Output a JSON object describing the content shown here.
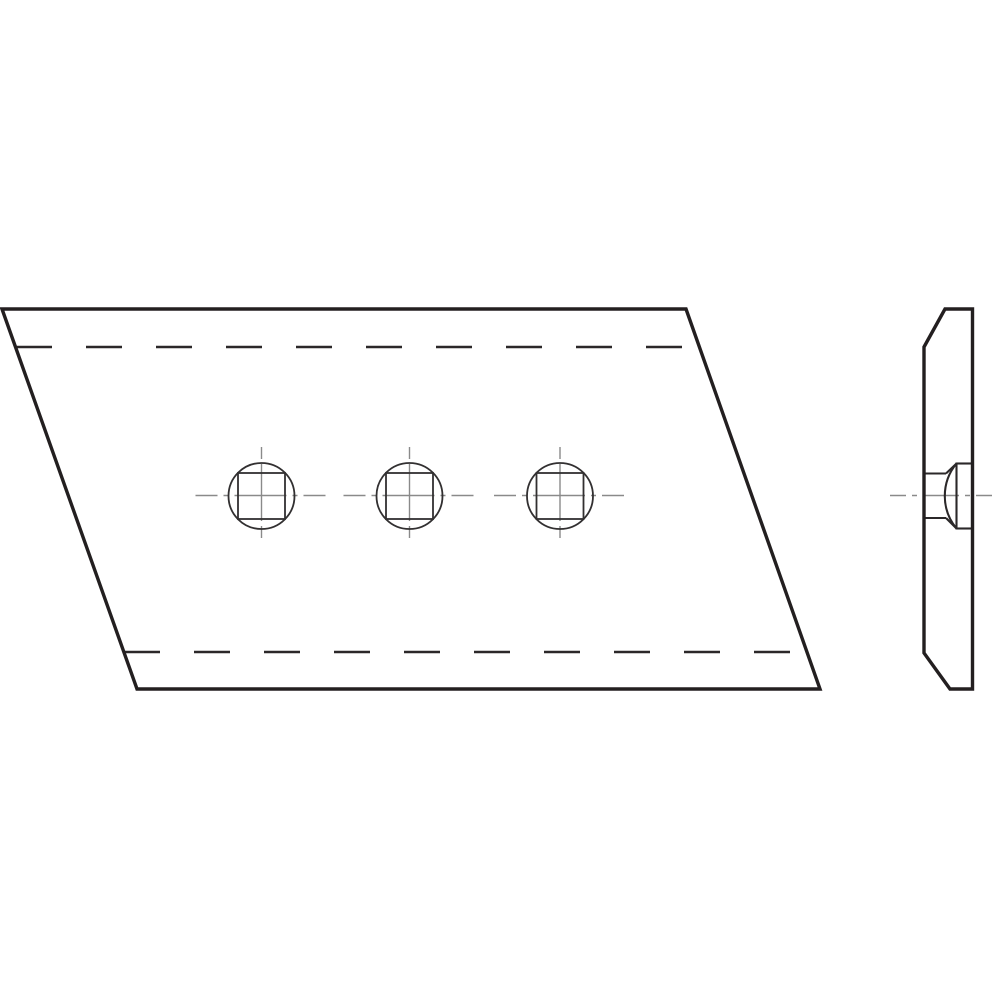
{
  "page": {
    "background": "#ffffff",
    "width": 1000,
    "height": 1000
  },
  "drawing": {
    "description": "Orthographic technical drawing: parallelogram blade plate with three countersunk square bolt holes (front view) and edge profile with flush plow-bolt head (side view)",
    "colors": {
      "ink": "#231f20",
      "feature": "#323031",
      "centerline": "#8a8a8a",
      "background": "#ffffff"
    },
    "line_styles": {
      "outline": {
        "stroke": "#231f20",
        "width": 3.4,
        "dash": ""
      },
      "hidden": {
        "stroke": "#2b2829",
        "width": 2.4,
        "dash": "36 34"
      },
      "feature": {
        "stroke": "#323031",
        "width": 1.8,
        "dash": ""
      },
      "bolt": {
        "stroke": "#2b2829",
        "width": 2.1,
        "dash": ""
      },
      "center_h": {
        "stroke": "#8a8a8a",
        "width": 1.4,
        "dash": "22 6 5 6 52 6 5 6"
      },
      "center_v": {
        "stroke": "#8a8a8a",
        "width": 1.4,
        "dash": "12 5 57 5"
      },
      "center_s": {
        "stroke": "#8a8a8a",
        "width": 1.4,
        "dash": "16 6 5 6 36 6 5 6"
      }
    },
    "front_view": {
      "elements": [
        {
          "type": "line",
          "name": "hole-1-centerline-horizontal",
          "style": "center_h",
          "x1": 195.5,
          "y1": 495.5,
          "x2": 327.5,
          "y2": 495.5
        },
        {
          "type": "line",
          "name": "hole-1-centerline-vertical",
          "style": "center_v",
          "x1": 261.5,
          "y1": 447,
          "x2": 261.5,
          "y2": 538
        },
        {
          "type": "line",
          "name": "hole-2-centerline-horizontal",
          "style": "center_h",
          "x1": 343.5,
          "y1": 495.5,
          "x2": 475.5,
          "y2": 495.5
        },
        {
          "type": "line",
          "name": "hole-2-centerline-vertical",
          "style": "center_v",
          "x1": 409.5,
          "y1": 447,
          "x2": 409.5,
          "y2": 538
        },
        {
          "type": "line",
          "name": "hole-3-centerline-horizontal",
          "style": "center_h",
          "x1": 494,
          "y1": 495.5,
          "x2": 626,
          "y2": 495.5
        },
        {
          "type": "line",
          "name": "hole-3-centerline-vertical",
          "style": "center_v",
          "x1": 560,
          "y1": 447,
          "x2": 560,
          "y2": 538
        },
        {
          "type": "line",
          "name": "hidden-bend-line-top",
          "style": "hidden",
          "x1": 16,
          "y1": 347,
          "x2": 700,
          "y2": 347
        },
        {
          "type": "line",
          "name": "hidden-bend-line-bottom",
          "style": "hidden",
          "x1": 124,
          "y1": 652,
          "x2": 809,
          "y2": 652
        },
        {
          "type": "circle",
          "name": "hole-1-circle",
          "style": "feature",
          "cx": 261.5,
          "cy": 496,
          "r": 33
        },
        {
          "type": "rect",
          "name": "hole-1-square",
          "style": "feature",
          "x": 238,
          "y": 473,
          "w": 47,
          "h": 46
        },
        {
          "type": "circle",
          "name": "hole-2-circle",
          "style": "feature",
          "cx": 409.5,
          "cy": 496,
          "r": 33
        },
        {
          "type": "rect",
          "name": "hole-2-square",
          "style": "feature",
          "x": 386,
          "y": 473,
          "w": 47,
          "h": 46
        },
        {
          "type": "circle",
          "name": "hole-3-circle",
          "style": "feature",
          "cx": 560,
          "cy": 496,
          "r": 33
        },
        {
          "type": "rect",
          "name": "hole-3-square",
          "style": "feature",
          "x": 536.5,
          "y": 473,
          "w": 47,
          "h": 46
        },
        {
          "type": "polygon",
          "name": "front-view-outline",
          "style": "outline",
          "points": "2,309 686,309 820,689 137,689"
        }
      ]
    },
    "side_view": {
      "elements": [
        {
          "type": "line",
          "name": "side-view-centerline",
          "style": "center_s",
          "x1": 890,
          "y1": 495.5,
          "x2": 995,
          "y2": 495.5
        },
        {
          "type": "line",
          "name": "bolt-hole-top-line",
          "style": "bolt",
          "x1": 922.5,
          "y1": 473.5,
          "x2": 946,
          "y2": 473.5
        },
        {
          "type": "line",
          "name": "bolt-hole-bottom-line",
          "style": "bolt",
          "x1": 922.5,
          "y1": 518,
          "x2": 946,
          "y2": 518
        },
        {
          "type": "line",
          "name": "countersink-top-line",
          "style": "bolt",
          "x1": 946,
          "y1": 473.5,
          "x2": 956.5,
          "y2": 463.5
        },
        {
          "type": "line",
          "name": "countersink-bottom-line",
          "style": "bolt",
          "x1": 946,
          "y1": 518,
          "x2": 956.5,
          "y2": 528.5
        },
        {
          "type": "line",
          "name": "bolt-head-face-line",
          "style": "bolt",
          "x1": 956.5,
          "y1": 462.5,
          "x2": 956.5,
          "y2": 529.5
        },
        {
          "type": "line",
          "name": "bolt-head-top-line",
          "style": "bolt",
          "x1": 956.5,
          "y1": 463.5,
          "x2": 972,
          "y2": 463.5
        },
        {
          "type": "line",
          "name": "bolt-head-bottom-line",
          "style": "bolt",
          "x1": 956.5,
          "y1": 528.5,
          "x2": 972,
          "y2": 528.5
        },
        {
          "type": "path",
          "name": "bolt-head-dome-arc",
          "style": "bolt",
          "d": "M 956.5 463.5 A 51 51 0 0 0 956.5 528.5"
        },
        {
          "type": "polygon",
          "name": "side-view-outline",
          "style": "outline",
          "points": "945,309 972.5,309 972.5,689 950,689 924,653 924,347"
        }
      ]
    }
  }
}
